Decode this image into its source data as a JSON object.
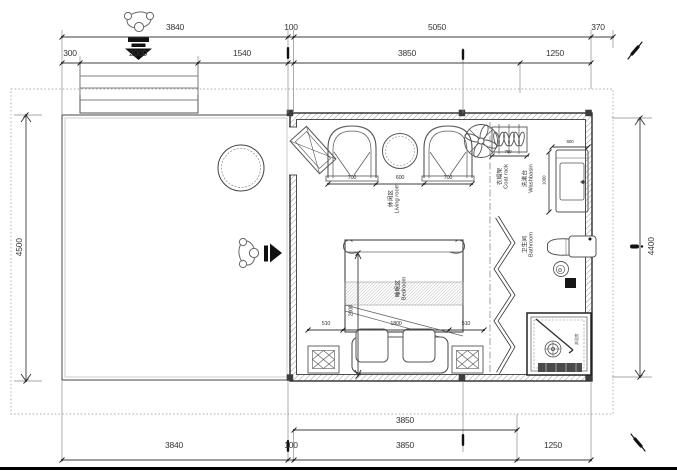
{
  "colors": {
    "line": "#3a3a3a",
    "dim": "#444444",
    "wall": "#1a1a1a",
    "background": "#ffffff"
  },
  "dims": {
    "top1_a": "3840",
    "top1_b": "100",
    "top1_c": "5050",
    "top1_d": "370",
    "top2_a": "300",
    "top2_b": "2000",
    "top2_c": "1540",
    "top2_d": "3850",
    "top2_e": "1250",
    "left": "4500",
    "right": "4400",
    "bot1": "3850",
    "bot2_a": "3840",
    "bot2_b": "100",
    "bot2_c": "3850",
    "bot2_d": "1250",
    "chair_left": "700",
    "table": "600",
    "chair_right": "700",
    "rack": "750",
    "basin_w": "500",
    "basin_h": "1000",
    "bed_side_l": "510",
    "bed_w": "1800",
    "bed_side_r": "510",
    "bed_len": "2000"
  },
  "rooms": {
    "living": {
      "zh": "休闲区",
      "en": "Living room"
    },
    "bedroom": {
      "zh": "睡眠区",
      "en": "Bedroom"
    },
    "washbasin": {
      "zh": "洗漱台",
      "en": "Washbasin"
    },
    "coat_rack": {
      "zh": "衣帽架",
      "en": "Coat rack"
    },
    "bathroom": {
      "zh": "卫生间",
      "en": "Bathroom"
    },
    "shower": {
      "zh": "淋浴房"
    }
  },
  "icons": {
    "entrance_person": "person-top-view-icon",
    "entrance_arrow": "down-arrow-icon",
    "deck_person": "person-top-view-icon",
    "deck_arrow": "right-arrow-icon",
    "ceiling_fan": "ceiling-fan-icon",
    "pen_marks": "pen-mark-icon"
  }
}
